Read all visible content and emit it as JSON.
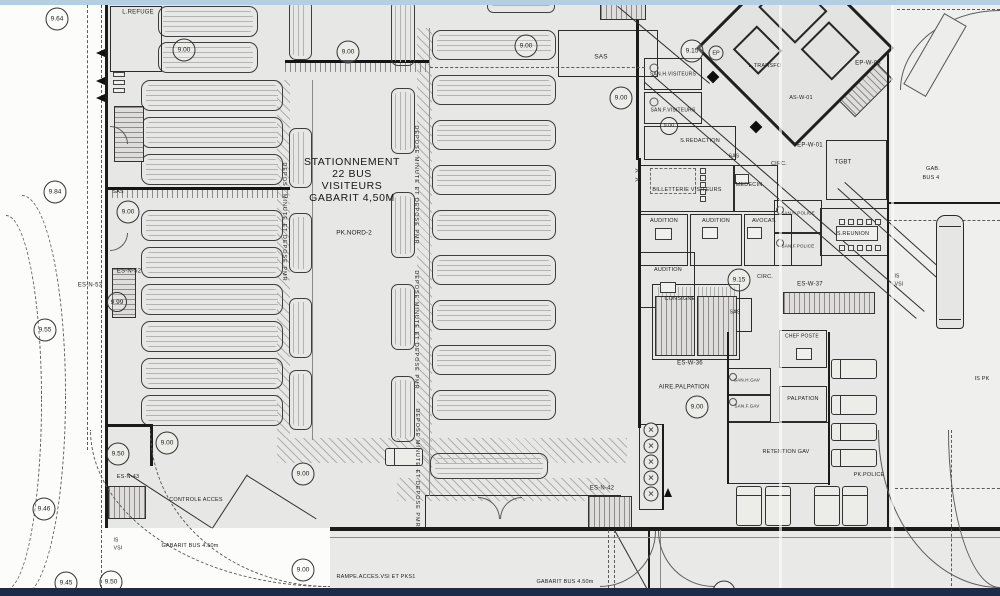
{
  "colors": {
    "paper": "#e7e7e5",
    "road": "#e9e9e7",
    "outside": "#fcfcfb",
    "line": "#2e2e2e",
    "wall": "#1b1b1b",
    "top_strip": "#b5cfe2",
    "bottom_strip": "#1d2b4b",
    "right_area": "#efefee"
  },
  "stationnement_block": {
    "line1": "STATIONNEMENT",
    "line2": "22 BUS",
    "line3": "VISITEURS",
    "line4": "GABARIT 4,50M",
    "zone": "PK.NORD-2"
  },
  "elevation_markers": [
    {
      "v": "9.64",
      "x": 57,
      "y": 19
    },
    {
      "v": "9.00",
      "x": 184,
      "y": 50
    },
    {
      "v": "9.00",
      "x": 348,
      "y": 52
    },
    {
      "v": "9.00",
      "x": 526,
      "y": 46
    },
    {
      "v": "9.15",
      "x": 692,
      "y": 51
    },
    {
      "v": "EP",
      "x": 716,
      "y": 53,
      "d": 15
    },
    {
      "v": "9.00",
      "x": 621,
      "y": 98
    },
    {
      "v": "9.00",
      "x": 669,
      "y": 126,
      "d": 18
    },
    {
      "v": "9.84",
      "x": 55,
      "y": 192
    },
    {
      "v": "9.00",
      "x": 128,
      "y": 212
    },
    {
      "v": "9.99",
      "x": 117,
      "y": 302,
      "d": 20
    },
    {
      "v": "9.55",
      "x": 45,
      "y": 330
    },
    {
      "v": "9.15",
      "x": 739,
      "y": 280
    },
    {
      "v": "9.00",
      "x": 697,
      "y": 407
    },
    {
      "v": "9.50",
      "x": 118,
      "y": 454
    },
    {
      "v": "9.00",
      "x": 167,
      "y": 443
    },
    {
      "v": "9.00",
      "x": 303,
      "y": 474
    },
    {
      "v": "9.46",
      "x": 44,
      "y": 509
    },
    {
      "v": "9.45",
      "x": 66,
      "y": 583
    },
    {
      "v": "9.50",
      "x": 111,
      "y": 582
    },
    {
      "v": "9.00",
      "x": 303,
      "y": 570
    },
    {
      "v": "9.15",
      "x": 724,
      "y": 592
    }
  ],
  "labels": [
    {
      "t": "L.REFUGE",
      "x": 138,
      "y": 13
    },
    {
      "t": "SAS",
      "x": 601,
      "y": 57,
      "s": 6.5
    },
    {
      "t": "SAN.H.VISITEURS",
      "x": 673,
      "y": 75,
      "s": 5
    },
    {
      "t": "SAN.F.VISITEURS",
      "x": 673,
      "y": 111,
      "s": 5
    },
    {
      "t": "S.REDACTION",
      "x": 700,
      "y": 141,
      "s": 5.5
    },
    {
      "t": "L.TRANSFO",
      "x": 765,
      "y": 66,
      "s": 5.5
    },
    {
      "t": "AS-W-01",
      "x": 801,
      "y": 98,
      "s": 5.5
    },
    {
      "t": "EP-W-03",
      "x": 868,
      "y": 64,
      "s": 6
    },
    {
      "t": "EP-W-01",
      "x": 810,
      "y": 146,
      "s": 6
    },
    {
      "t": "TGBT",
      "x": 843,
      "y": 163,
      "s": 6
    },
    {
      "t": "GAB.",
      "x": 933,
      "y": 169,
      "s": 5.5
    },
    {
      "t": "BUS 4",
      "x": 931,
      "y": 178,
      "s": 5.5
    },
    {
      "t": "BILLETTERIE VISITEURS",
      "x": 687,
      "y": 190,
      "s": 5.5
    },
    {
      "t": "MEDECIN",
      "x": 749,
      "y": 185,
      "s": 5.5
    },
    {
      "t": "SAS",
      "x": 734,
      "y": 157,
      "s": 5
    },
    {
      "t": "CIRC.",
      "x": 779,
      "y": 164,
      "s": 5.5
    },
    {
      "t": "AUDITION",
      "x": 664,
      "y": 221,
      "s": 5.5
    },
    {
      "t": "AUDITION",
      "x": 716,
      "y": 221,
      "s": 5.5
    },
    {
      "t": "AVOCAT.",
      "x": 764,
      "y": 221,
      "s": 5.5
    },
    {
      "t": "AUDITION",
      "x": 668,
      "y": 270,
      "s": 5.5
    },
    {
      "t": "CIRC.",
      "x": 765,
      "y": 277,
      "s": 5.5
    },
    {
      "t": "SAN.H.POLICE",
      "x": 798,
      "y": 214,
      "s": 4.5
    },
    {
      "t": "S.REUNION",
      "x": 853,
      "y": 234,
      "s": 5.5
    },
    {
      "t": "SAN.F.POLICE",
      "x": 798,
      "y": 247,
      "s": 4.5
    },
    {
      "t": "CONSIGNE",
      "x": 680,
      "y": 299,
      "s": 5.5
    },
    {
      "t": "SAS",
      "x": 735,
      "y": 313,
      "s": 5
    },
    {
      "t": "ES-W-36",
      "x": 690,
      "y": 364,
      "s": 6
    },
    {
      "t": "ES-W-37",
      "x": 810,
      "y": 285,
      "s": 6
    },
    {
      "t": "AIRE.PALPATION",
      "x": 684,
      "y": 388,
      "s": 6
    },
    {
      "t": "SAN.H.GAV",
      "x": 747,
      "y": 381,
      "s": 4.5
    },
    {
      "t": "SAN.F.GAV",
      "x": 747,
      "y": 407,
      "s": 4.5
    },
    {
      "t": "CHEF POSTE",
      "x": 802,
      "y": 337,
      "s": 5
    },
    {
      "t": "PALPATION",
      "x": 803,
      "y": 399,
      "s": 5.5
    },
    {
      "t": "RETENTION GAV",
      "x": 786,
      "y": 452,
      "s": 5.5
    },
    {
      "t": "PK.POLICE",
      "x": 869,
      "y": 475,
      "s": 5.5
    },
    {
      "t": "IS PK",
      "x": 982,
      "y": 379,
      "s": 5.5
    },
    {
      "t": "IS",
      "x": 897,
      "y": 277,
      "s": 5
    },
    {
      "t": "VSI",
      "x": 899,
      "y": 285,
      "s": 5
    },
    {
      "t": "IS",
      "x": 116,
      "y": 541,
      "s": 5
    },
    {
      "t": "VSI",
      "x": 118,
      "y": 549,
      "s": 5
    },
    {
      "t": "CONTROLE ACCES",
      "x": 196,
      "y": 500,
      "s": 5.5
    },
    {
      "t": "GABARIT BUS 4.50m",
      "x": 190,
      "y": 546,
      "s": 5.5
    },
    {
      "t": "RAMPE.ACCES.VSI ET PKS1",
      "x": 376,
      "y": 577,
      "s": 5.5
    },
    {
      "t": "GABARIT BUS 4.50m",
      "x": 565,
      "y": 582,
      "s": 5.5
    },
    {
      "t": "ES-N-53",
      "x": 90,
      "y": 286,
      "s": 6
    },
    {
      "t": "ES-N-52",
      "x": 129,
      "y": 272,
      "s": 6
    },
    {
      "t": "ES-N-42",
      "x": 602,
      "y": 489,
      "s": 6
    },
    {
      "t": "ES-N-43",
      "x": 128,
      "y": 477,
      "s": 5.5
    },
    {
      "t": "SAS",
      "x": 118,
      "y": 192,
      "s": 5.5
    },
    {
      "t": ">",
      "x": 637,
      "y": 172,
      "s": 7
    },
    {
      "t": ">",
      "x": 637,
      "y": 181,
      "s": 7
    },
    {
      "t": "DEPOSE MINUTE ET DEPOSE PMR",
      "x": 284,
      "y": 222,
      "s": 5.5,
      "r": 90,
      "ls": 1
    },
    {
      "t": "DEPOSE MINUTE ET DEPOSE PMR",
      "x": 416,
      "y": 185,
      "s": 5.5,
      "r": 90,
      "ls": 1
    },
    {
      "t": "DEPOSE MINUTE ET DEPOSE PMR",
      "x": 416,
      "y": 330,
      "s": 5.5,
      "r": 90,
      "ls": 1
    },
    {
      "t": "DEPOSE MINUTE ET DEPOSE PMR",
      "x": 417,
      "y": 468,
      "s": 5.5,
      "r": 90,
      "ls": 1
    }
  ],
  "bus_bays_h": [
    {
      "x": 158,
      "w": 100,
      "h": 31,
      "ys": [
        6,
        42
      ]
    },
    {
      "x": 141,
      "w": 142,
      "h": 31,
      "ys": [
        80,
        117,
        154,
        210,
        247,
        284,
        321,
        358,
        395
      ]
    },
    {
      "x": 432,
      "w": 124,
      "h": 30,
      "ys": [
        30,
        75,
        120,
        165,
        210,
        255,
        300,
        345,
        390
      ]
    },
    {
      "x": 430,
      "w": 118,
      "h": 26,
      "ys": [
        453
      ]
    },
    {
      "x": 487,
      "w": 68,
      "h": 13,
      "ys": [
        0
      ]
    }
  ],
  "bus_bays_v": [
    {
      "x": 289,
      "w": 23,
      "h": 60,
      "ys": [
        0,
        128,
        213,
        298,
        370
      ]
    },
    {
      "x": 391,
      "w": 24,
      "h": 66,
      "ys": [
        0,
        88,
        192,
        284,
        376
      ]
    }
  ],
  "stairs": [
    {
      "x": 114,
      "y": 106,
      "w": 30,
      "h": 56,
      "dir": "h"
    },
    {
      "x": 112,
      "y": 268,
      "w": 24,
      "h": 50,
      "dir": "h"
    },
    {
      "x": 108,
      "y": 486,
      "w": 38,
      "h": 33,
      "dir": "v"
    },
    {
      "x": 588,
      "y": 496,
      "w": 44,
      "h": 35,
      "dir": "v"
    },
    {
      "x": 655,
      "y": 296,
      "w": 40,
      "h": 60,
      "dir": "v"
    },
    {
      "x": 697,
      "y": 296,
      "w": 40,
      "h": 60,
      "dir": "v"
    },
    {
      "x": 783,
      "y": 292,
      "w": 92,
      "h": 22,
      "dir": "v"
    },
    {
      "x": 600,
      "y": 4,
      "w": 46,
      "h": 16,
      "dir": "v"
    },
    {
      "x": 852,
      "y": 62,
      "w": 26,
      "h": 54,
      "dir": "h",
      "r": 45
    }
  ],
  "hatches": [
    {
      "x": 277,
      "y": 80,
      "w": 13,
      "h": 358,
      "a": 45,
      "g": 6
    },
    {
      "x": 417,
      "y": 28,
      "w": 15,
      "h": 467,
      "a": 45,
      "g": 6
    },
    {
      "x": 277,
      "y": 438,
      "w": 350,
      "h": 25,
      "a": 45,
      "g": 6
    },
    {
      "x": 397,
      "y": 478,
      "w": 213,
      "h": 23,
      "a": 45,
      "g": 6
    },
    {
      "x": 658,
      "y": 287,
      "w": 80,
      "h": 9,
      "a": 90,
      "g": 4
    }
  ],
  "bands": [
    {
      "x": 285,
      "y": 60,
      "w": 145,
      "h": 12
    },
    {
      "x": 107,
      "y": 187,
      "w": 183,
      "h": 11
    }
  ],
  "walls": [
    [
      105,
      5,
      3,
      523
    ],
    [
      330,
      527,
      670,
      4
    ],
    [
      887,
      45,
      2,
      483
    ],
    [
      889,
      202,
      111,
      2
    ],
    [
      828,
      332,
      2,
      153
    ],
    [
      727,
      332,
      2,
      152
    ],
    [
      638,
      158,
      3,
      270
    ],
    [
      636,
      20,
      3,
      140
    ],
    [
      105,
      424,
      48,
      3
    ],
    [
      150,
      424,
      3,
      42
    ],
    [
      662,
      424,
      2,
      86
    ],
    [
      648,
      530,
      2,
      58
    ]
  ],
  "rooms": [
    {
      "x": 110,
      "y": 6,
      "w": 52,
      "h": 66
    },
    {
      "x": 558,
      "y": 30,
      "w": 100,
      "h": 47
    },
    {
      "x": 644,
      "y": 58,
      "w": 58,
      "h": 32
    },
    {
      "x": 644,
      "y": 92,
      "w": 58,
      "h": 32
    },
    {
      "x": 644,
      "y": 126,
      "w": 92,
      "h": 34
    },
    {
      "x": 640,
      "y": 165,
      "w": 94,
      "h": 47
    },
    {
      "x": 734,
      "y": 165,
      "w": 44,
      "h": 47
    },
    {
      "x": 640,
      "y": 214,
      "w": 48,
      "h": 52
    },
    {
      "x": 690,
      "y": 214,
      "w": 52,
      "h": 52
    },
    {
      "x": 744,
      "y": 214,
      "w": 48,
      "h": 52
    },
    {
      "x": 640,
      "y": 252,
      "w": 55,
      "h": 56
    },
    {
      "x": 652,
      "y": 284,
      "w": 88,
      "h": 76
    },
    {
      "x": 718,
      "y": 298,
      "w": 34,
      "h": 34
    },
    {
      "x": 774,
      "y": 200,
      "w": 48,
      "h": 33
    },
    {
      "x": 774,
      "y": 233,
      "w": 48,
      "h": 33
    },
    {
      "x": 820,
      "y": 208,
      "w": 68,
      "h": 48
    },
    {
      "x": 779,
      "y": 330,
      "w": 48,
      "h": 38
    },
    {
      "x": 779,
      "y": 386,
      "w": 48,
      "h": 36
    },
    {
      "x": 727,
      "y": 368,
      "w": 44,
      "h": 27
    },
    {
      "x": 727,
      "y": 395,
      "w": 44,
      "h": 27
    },
    {
      "x": 727,
      "y": 422,
      "w": 102,
      "h": 62
    },
    {
      "x": 425,
      "y": 495,
      "w": 196,
      "h": 34
    },
    {
      "x": 639,
      "y": 424,
      "w": 24,
      "h": 86
    },
    {
      "x": 826,
      "y": 140,
      "w": 61,
      "h": 60
    }
  ],
  "dashed_rects": [
    [
      650,
      168,
      46,
      26
    ]
  ],
  "lines": [
    {
      "x": 128,
      "y": 473,
      "l": 100,
      "a": 33
    },
    {
      "x": 212,
      "y": 528,
      "l": 64,
      "a": -57
    },
    {
      "x": 247,
      "y": 475,
      "l": 82,
      "a": 32
    },
    {
      "x": 618,
      "y": 6,
      "l": 120,
      "a": 40
    },
    {
      "x": 645,
      "y": 82,
      "l": 360,
      "a": 41
    },
    {
      "x": 653,
      "y": 75,
      "l": 360,
      "a": 41
    },
    {
      "x": 838,
      "y": 188,
      "l": 150,
      "a": 42
    },
    {
      "x": 845,
      "y": 182,
      "l": 150,
      "a": 42
    },
    {
      "x": 615,
      "y": 530,
      "l": 66,
      "a": 61
    },
    {
      "x": 313,
      "y": 80,
      "l": 360,
      "a": 90,
      "c": "thin"
    },
    {
      "x": 430,
      "y": 28,
      "l": 468,
      "a": 90,
      "c": "thin"
    },
    {
      "x": 330,
      "y": 537,
      "l": 670,
      "a": 0,
      "c": "thin"
    },
    {
      "x": 430,
      "y": 67,
      "l": 215,
      "a": 0,
      "c": "dash"
    },
    {
      "x": 889,
      "y": 220,
      "l": 111,
      "a": 0,
      "c": "dash"
    },
    {
      "x": 897,
      "y": 9,
      "l": 103,
      "a": 0,
      "c": "dash"
    },
    {
      "x": 895,
      "y": 488,
      "l": 105,
      "a": 0,
      "c": "dash"
    },
    {
      "x": 952,
      "y": 430,
      "l": 166,
      "a": 90,
      "c": "dash"
    },
    {
      "x": 88,
      "y": 0,
      "l": 450,
      "a": 90,
      "c": "dash"
    },
    {
      "x": 102,
      "y": 5,
      "l": 583,
      "a": 90,
      "c": "dash"
    },
    {
      "x": 609,
      "y": 530,
      "l": 58,
      "a": 90,
      "c": "dash"
    },
    {
      "x": 615,
      "y": 530,
      "l": 58,
      "a": 90,
      "c": "dash"
    },
    {
      "x": 661,
      "y": 530,
      "l": 58,
      "a": 90,
      "c": "thin"
    }
  ],
  "arcs": [
    {
      "x": 478,
      "y": 497,
      "w": 22,
      "h": 22,
      "c": "tr"
    },
    {
      "x": 500,
      "y": 497,
      "w": 22,
      "h": 22,
      "c": "tl"
    },
    {
      "x": 600,
      "y": 531,
      "w": 56,
      "h": 56,
      "c": "br"
    },
    {
      "x": 658,
      "y": 531,
      "w": 56,
      "h": 56,
      "c": "bl"
    },
    {
      "x": 110,
      "y": 126,
      "w": 18,
      "h": 18,
      "c": "tr"
    },
    {
      "x": 110,
      "y": 233,
      "w": 18,
      "h": 18,
      "c": "br"
    },
    {
      "x": 878,
      "y": 430,
      "w": 122,
      "h": 158,
      "c": "bl"
    },
    {
      "x": 948,
      "y": 430,
      "w": 52,
      "h": 158,
      "c": "bl"
    },
    {
      "x": 900,
      "y": 10,
      "w": 100,
      "h": 80,
      "c": "tl"
    },
    {
      "x": 22,
      "y": 195,
      "w": 44,
      "h": 200,
      "c": "tr",
      "d": 1
    },
    {
      "x": 22,
      "y": 395,
      "w": 44,
      "h": 201,
      "c": "br",
      "d": 1
    },
    {
      "x": 6,
      "y": 215,
      "w": 36,
      "h": 185,
      "c": "tr",
      "d": 1
    },
    {
      "x": 6,
      "y": 400,
      "w": 36,
      "h": 190,
      "c": "br",
      "d": 1
    },
    {
      "x": 90,
      "y": 430,
      "w": 240,
      "h": 157,
      "c": "bl",
      "d": 1
    },
    {
      "x": 150,
      "y": 430,
      "w": 180,
      "h": 157,
      "c": "bl",
      "d": 1
    }
  ],
  "vans_h": [
    [
      831,
      359,
      46,
      20
    ],
    [
      831,
      395,
      46,
      20
    ],
    [
      831,
      423,
      46,
      18
    ],
    [
      831,
      449,
      46,
      18
    ],
    [
      385,
      448,
      38,
      18
    ]
  ],
  "vans_v": [
    [
      736,
      486,
      26,
      40
    ],
    [
      765,
      486,
      26,
      40
    ],
    [
      814,
      486,
      26,
      40
    ],
    [
      842,
      486,
      26,
      40
    ]
  ],
  "bus": {
    "x": 936,
    "y": 215,
    "w": 28,
    "h": 114
  },
  "turnstiles": {
    "x": 651,
    "y0": 430,
    "n": 5,
    "pitch": 16,
    "d": 15,
    "glyph": "✕"
  },
  "desks": [
    [
      655,
      228,
      17,
      12
    ],
    [
      702,
      227,
      16,
      12
    ],
    [
      747,
      227,
      15,
      12
    ],
    [
      660,
      282,
      16,
      11
    ],
    [
      735,
      174,
      14,
      10
    ],
    [
      796,
      348,
      16,
      12
    ],
    [
      836,
      226,
      42,
      15
    ]
  ],
  "squares": [
    [
      700,
      168,
      6,
      6
    ],
    [
      700,
      175,
      6,
      6
    ],
    [
      700,
      182,
      6,
      6
    ],
    [
      700,
      189,
      6,
      6
    ],
    [
      700,
      196,
      6,
      6
    ],
    [
      839,
      219,
      6,
      6
    ],
    [
      848,
      219,
      6,
      6
    ],
    [
      857,
      219,
      6,
      6
    ],
    [
      866,
      219,
      6,
      6
    ],
    [
      875,
      219,
      6,
      6
    ],
    [
      839,
      245,
      6,
      6
    ],
    [
      848,
      245,
      6,
      6
    ],
    [
      857,
      245,
      6,
      6
    ],
    [
      866,
      245,
      6,
      6
    ],
    [
      875,
      245,
      6,
      6
    ],
    [
      113,
      72,
      12,
      5
    ],
    [
      113,
      80,
      12,
      5
    ],
    [
      113,
      88,
      12,
      5
    ]
  ],
  "fixtures": [
    [
      654,
      68,
      9
    ],
    [
      654,
      102,
      9
    ],
    [
      733,
      377,
      8
    ],
    [
      733,
      402,
      8
    ],
    [
      780,
      210,
      8
    ],
    [
      780,
      243,
      8
    ]
  ],
  "columns": [
    [
      713,
      77
    ],
    [
      766,
      23
    ],
    [
      837,
      38
    ],
    [
      756,
      127
    ]
  ],
  "arrows": [
    {
      "x": 96,
      "y": 49,
      "d": "left"
    },
    {
      "x": 96,
      "y": 77,
      "d": "left"
    },
    {
      "x": 96,
      "y": 94,
      "d": "left"
    },
    {
      "x": 664,
      "y": 488,
      "d": "up"
    }
  ],
  "wing": {
    "x": 725,
    "y": -22,
    "size": 140,
    "children": [
      [
        12,
        18,
        52,
        46
      ],
      [
        72,
        24,
        44,
        40
      ],
      [
        24,
        78,
        36,
        34
      ]
    ]
  },
  "ramp_rect": {
    "x": 922,
    "y": 14,
    "w": 26,
    "h": 82,
    "r": 30
  },
  "seams": [
    779,
    891
  ]
}
